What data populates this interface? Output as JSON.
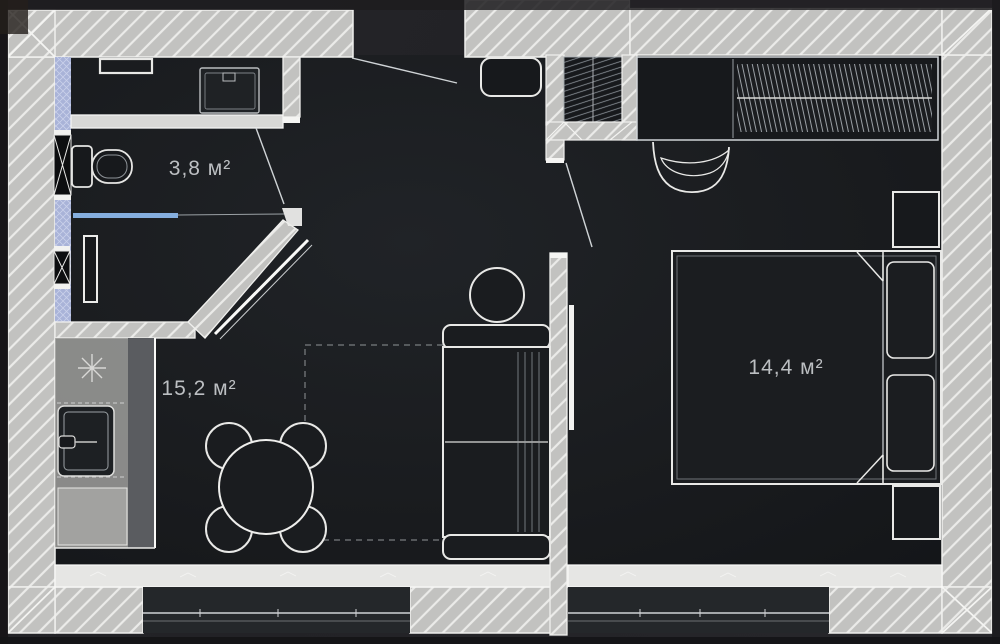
{
  "meta": {
    "title": "Apartment floor plan",
    "style": "dark architectural render, top view"
  },
  "rooms": [
    {
      "id": "bathroom",
      "area_label": "3,8 м²"
    },
    {
      "id": "kitchen-living-room",
      "area_label": "15,2 м²"
    },
    {
      "id": "bedroom",
      "area_label": "14,4 м²"
    }
  ],
  "colors": {
    "background": "#232327",
    "floor": "#1a1c1f",
    "wall": "#c2c2c0",
    "wall_hatch": "#ebebe9",
    "wall_outline": "#f0f0ee",
    "sill_band": "#e6e6e4",
    "vent_shaft_blue": "#a9b3d8",
    "glass_partition_blue": "#85aede",
    "furniture_outline": "#e9e9e9",
    "label_text": "#bcbfc2"
  },
  "furniture_legend": [
    "wall-shelf",
    "washing-machine",
    "toilet",
    "shower-glass-partition",
    "towel-radiator",
    "vent-shaft",
    "kitchen-counter",
    "cooktop-symbol",
    "kitchen-sink",
    "dining-table",
    "dining-chair",
    "rug-outline",
    "sofa",
    "side-table",
    "tv",
    "entry-pouf",
    "entry-closet",
    "wardrobe",
    "armchair",
    "double-bed",
    "pillow",
    "nightstand",
    "window",
    "door-leaf"
  ]
}
